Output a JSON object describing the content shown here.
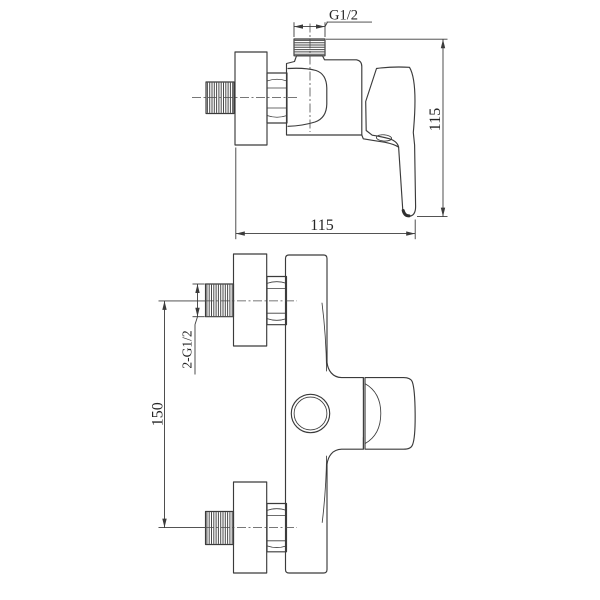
{
  "drawing": {
    "background_color": "#ffffff",
    "line_color": "#3b3b3b",
    "text_color": "#262626",
    "side_view": {
      "outlet_thread_dim": "G1/2",
      "height_dim": "115",
      "width_dim": "115"
    },
    "front_view": {
      "inlet_thread_dim": "2-G1/2",
      "inlet_spacing_dim": "150"
    }
  }
}
